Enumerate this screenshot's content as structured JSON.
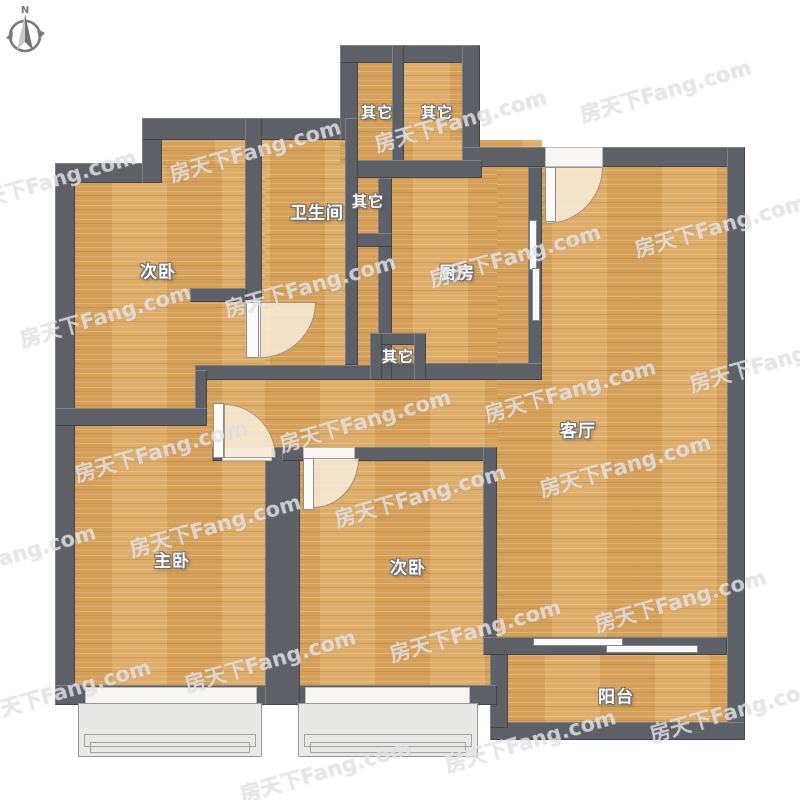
{
  "page": {
    "type": "apartment-floor-plan",
    "background": "#ffffff"
  },
  "compass": {
    "label": "N"
  },
  "watermark": {
    "text": "房天下Fang.com"
  },
  "rooms": [
    {
      "id": "bedroom-second-topleft",
      "label": "次卧"
    },
    {
      "id": "bathroom",
      "label": "卫生间"
    },
    {
      "id": "utility-shaft-1",
      "label": "其它"
    },
    {
      "id": "utility-shaft-2",
      "label": "其它"
    },
    {
      "id": "utility-shaft-3",
      "label": "其它"
    },
    {
      "id": "kitchen",
      "label": "厨房"
    },
    {
      "id": "utility-niche",
      "label": "其它"
    },
    {
      "id": "living-room",
      "label": "客厅"
    },
    {
      "id": "master-bedroom",
      "label": "主卧"
    },
    {
      "id": "bedroom-second-bottom",
      "label": "次卧"
    },
    {
      "id": "balcony",
      "label": "阳台"
    }
  ],
  "colors": {
    "wall": "#5d6067",
    "floor_wood": "#dca75f",
    "window_white": "#f7f6f3",
    "door_arc": "#f6ebd6",
    "bay_window": "#e8e8e6"
  }
}
